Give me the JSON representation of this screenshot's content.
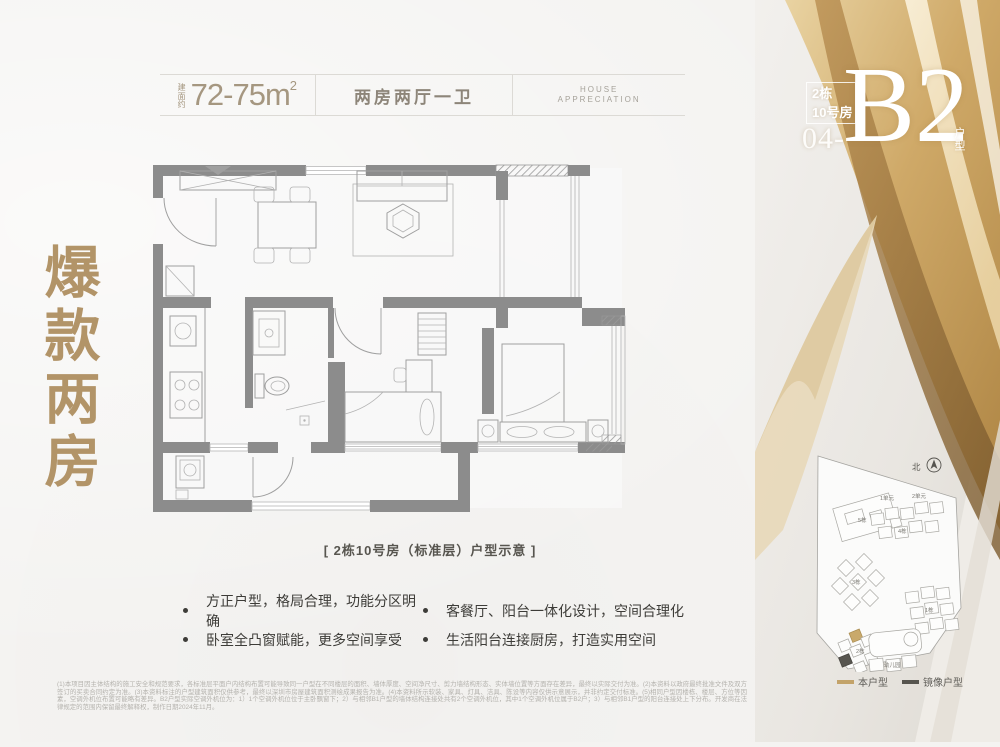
{
  "header": {
    "area_prefix": "建面约",
    "area_value": "72-75m",
    "area_sup": "2",
    "layout": "两房两厅一卫",
    "tagline_line1": "HOUSE",
    "tagline_line2": "APPRECIATION"
  },
  "side_title": "爆款两房",
  "unit_badge": {
    "building": "2栋",
    "room": "10号房",
    "number": "04-",
    "code": "B2",
    "type_label": "户型"
  },
  "floorplan": {
    "caption": "[ 2栋10号房（标准层）户型示意 ]"
  },
  "highlights": [
    "方正户型，格局合理，功能分区明确",
    "客餐厅、阳台一体化设计，空间合理化",
    "卧室全凸窗赋能，更多空间享受",
    "生活阳台连接厨房，打造实用空间"
  ],
  "siteplan": {
    "compass": "北",
    "labels": {
      "b5": "5栋",
      "u1": "1单元",
      "u2": "2单元",
      "b4": "4栋",
      "b3": "3栋",
      "b1": "1栋",
      "b2": "2栋",
      "kg": "幼儿园"
    },
    "legend": [
      {
        "label": "本户型",
        "color": "#c3a36a"
      },
      {
        "label": "镜像户型",
        "color": "#57554f"
      }
    ]
  },
  "disclaimer": "(1)本项目因主体结构的施工安全和规范要求，各标准层平面户内结构布置可能导致同一户型在不同楼层的面积、墙体厚度、空间净尺寸、剪力墙结构形态、实体墙位置等方面存在差异，最终以实际交付为准。(2)本资料以政府最终批准文件及双方签订的买卖合同约定为准。(3)本资料标注的户型建筑面积仅供参考，最终以深圳市房屋建筑面积测绘成果报告为准。(4)本资料所示软装、家具、灯具、洁具、陈设等内容仅供示意展示，并非约定交付标准。(5)相同户型因楼栋、楼层、方位等因素，空调外机位布置可能略有差异。B2户型实际空调外机位为：1）1个空调外机位位于主卧飘窗下；2）与相邻B1户型的墙体结构连接处共有2个空调外机位，其中1个空调外机位属于B2户；3）与相邻B1户型的阳台连接处上下分布。开发商在法律规定的范围内保留最终解释权，制作日期2024年11月。"
}
